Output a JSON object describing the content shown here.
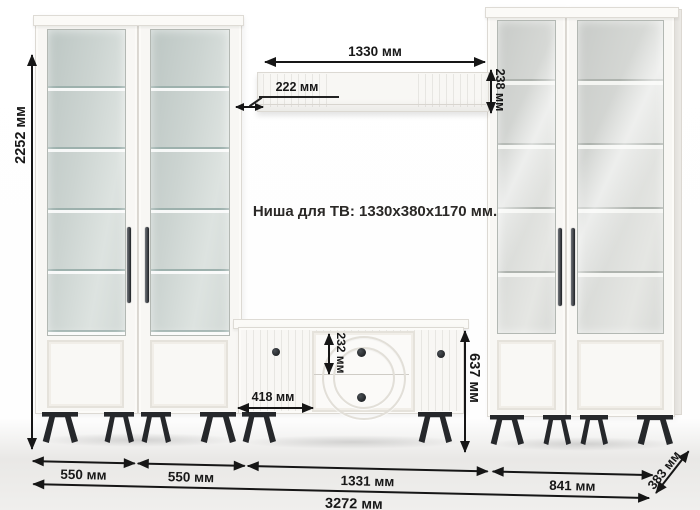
{
  "niche": {
    "label": "Ниша для ТВ: 1330х380х1170 мм."
  },
  "dimensions": {
    "total_height": "2252 мм",
    "tv_shelf_width": "1330 мм",
    "tv_shelf_offset": "222 мм",
    "tv_shelf_depth": "238 мм",
    "top_drawer_height": "232 мм",
    "stand_door_width": "418 мм",
    "tv_stand_height": "637 мм",
    "left_cabinet_one_width": "550 мм",
    "left_cabinet_two_width": "550 мм",
    "tv_stand_width": "1331 мм",
    "right_cabinets_width": "841 мм",
    "total_width": "3272 мм",
    "unit_depth": "383 мм"
  },
  "colors": {
    "cabinet_body": "#f8f7f4",
    "glass_tint_left": "#c5cfcc",
    "glass_tint_right": "#d6d8d5",
    "legs_and_knobs": "#26282b",
    "dimension_lines": "#161616",
    "floor": "#e9e8e6"
  }
}
